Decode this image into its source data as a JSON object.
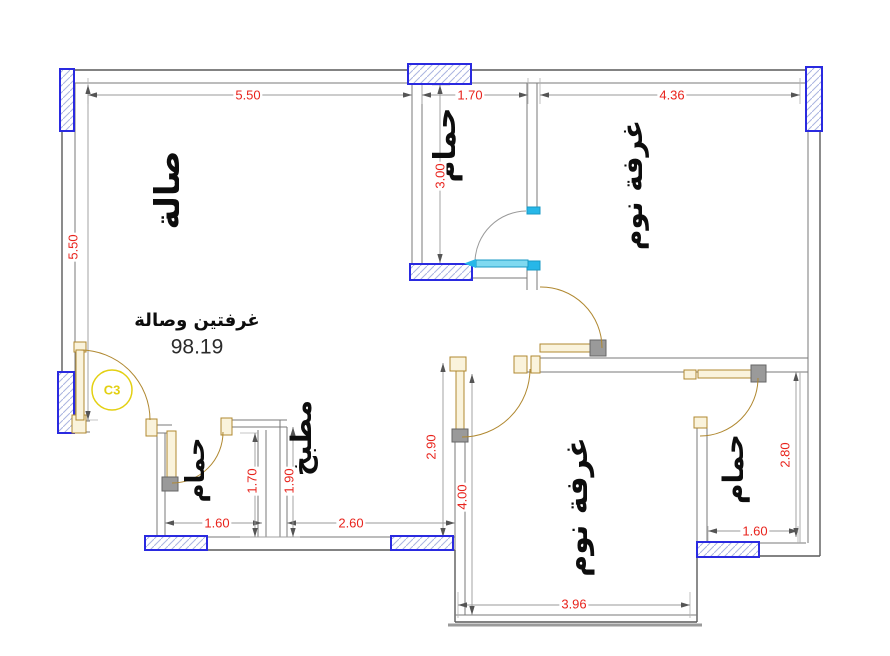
{
  "plan": {
    "unit_mark": "C3",
    "summary_label": "غرفتين وصالة",
    "area_value": "98.19",
    "rooms": [
      {
        "id": "hall",
        "label": "صالة"
      },
      {
        "id": "bathroom-top",
        "label": "حمام"
      },
      {
        "id": "bedroom-1",
        "label": "غرفة نوم"
      },
      {
        "id": "kitchen",
        "label": "مطبخ"
      },
      {
        "id": "bathroom-left",
        "label": "حمام"
      },
      {
        "id": "bedroom-2",
        "label": "غرفة نوم"
      },
      {
        "id": "bathroom-right",
        "label": "حمام"
      }
    ],
    "dimensions": {
      "hall_width": "5.50",
      "hall_height": "5.50",
      "bathroom_top_width": "1.70",
      "bathroom_top_height": "3.00",
      "bedroom1_width": "4.36",
      "kitchen_height": "2.90",
      "kitchen_width": "2.60",
      "kitchen_depth": "1.90",
      "bathroom_left_width": "1.60",
      "bathroom_left_height": "1.70",
      "bedroom2_height": "4.00",
      "bedroom2_width": "3.96",
      "bathroom_right_width": "1.60",
      "bathroom_right_height": "2.80"
    },
    "colors": {
      "dimension_text": "#e8231c",
      "window": "#2a2ae0",
      "door_wood": "#b08830",
      "door_sliding": "#27b7e8",
      "mark": "#e3d012",
      "wall": "#6f6f6f"
    }
  }
}
